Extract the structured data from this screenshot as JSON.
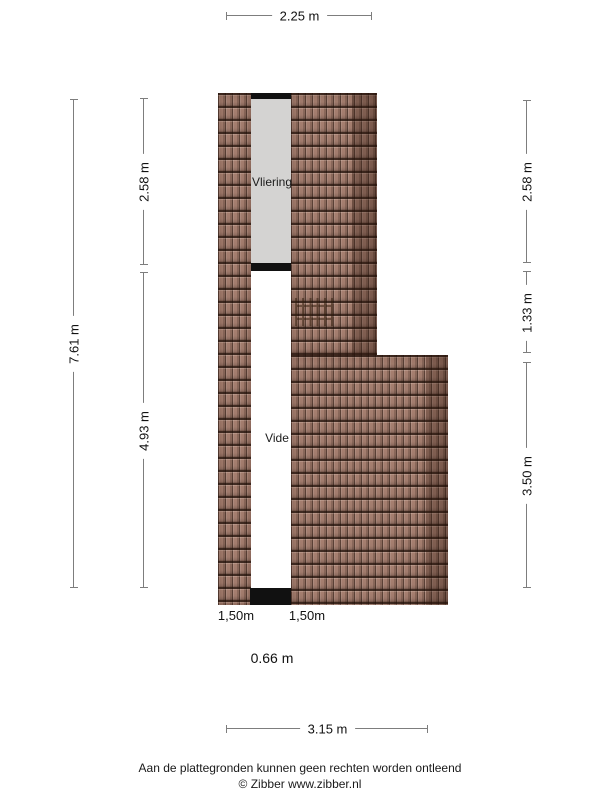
{
  "plan": {
    "rooms": [
      {
        "label": "Vliering"
      },
      {
        "label": "Vide"
      }
    ]
  },
  "dimensions": {
    "top_width": "2.25 m",
    "left_total_height": "7.61 m",
    "left_upper_height": "2.58 m",
    "left_lower_height": "4.93 m",
    "right_upper_height": "2.58 m",
    "right_middle_height": "1.33 m",
    "right_lower_height": "3.50 m",
    "bottom_width": "3.15 m",
    "headroom_left": "1,50m",
    "headroom_right": "1,50m",
    "void_width": "0.66 m"
  },
  "footer": {
    "disclaimer": "Aan de plattegronden kunnen geen rechten worden ontleend",
    "credit": "© Zibber www.zibber.nl"
  },
  "colors": {
    "roof_tile": "#a67f70",
    "roof_edge_shade": "#5e3c2c",
    "attic_floor": "#d4d3d2",
    "wall": "#111111",
    "dimension_line": "#7d7d7d"
  }
}
